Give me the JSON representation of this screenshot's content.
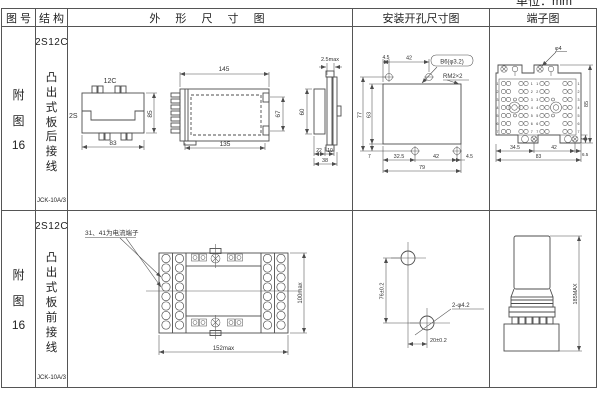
{
  "page": {
    "unit_label": "单位：mm"
  },
  "header": {
    "fig_no": "图 号",
    "structure": "结 构",
    "outline": "外 形 尺 寸 图",
    "mounting": "安装开孔尺寸图",
    "terminal": "端子图"
  },
  "rows": [
    {
      "fig": {
        "l1": "附",
        "l2": "图",
        "l3": "16"
      },
      "structure": {
        "model": "2S12C",
        "desc": "凸出式板后接线",
        "type": "JCK-10A/3"
      },
      "outline": {
        "top_view": {
          "label_top": "12C",
          "label_left": "2S",
          "height": "85",
          "width": "83"
        },
        "side_view": {
          "width_top": "145",
          "width_bottom": "135",
          "height": "67"
        },
        "profile": {
          "thickness": "2.5max",
          "height": "60",
          "d1": "22",
          "d2": "10",
          "d3": "38"
        }
      },
      "mounting": {
        "top_d1": "4.5",
        "top_d2": "42",
        "hole_label": "B6(φ3.2)",
        "thread_label": "RM2×2",
        "left_d1": "77",
        "left_d2": "63",
        "bottom_left": "7",
        "bottom_d1": "32.5",
        "bottom_d2": "42",
        "bottom_d3": "4.5",
        "bottom_total": "79"
      },
      "terminal": {
        "screw_label": "φ4",
        "height": "85",
        "foot_d": "4",
        "bottom_d1": "34.5",
        "bottom_d2": "42",
        "bottom_d3": "6.5",
        "bottom_total": "83",
        "left_rows": [
          "1",
          "2",
          "3",
          "4",
          "5",
          "6",
          "7"
        ],
        "center_rows": [
          "1",
          "2",
          "3",
          "4",
          "5",
          "6",
          "7"
        ],
        "right_rows": [
          "1",
          "2",
          "3",
          "4",
          "5",
          "6",
          "7"
        ]
      }
    },
    {
      "fig": {
        "l1": "附",
        "l2": "图",
        "l3": "16"
      },
      "structure": {
        "model": "2S12C",
        "desc": "凸出式板前接线",
        "type": "JCK-10A/3"
      },
      "outline": {
        "note": "31、41为电流端子",
        "width": "152max",
        "height": "100max"
      },
      "mounting": {
        "v_dim": "76±0.2",
        "h_dim": "20±0.2",
        "hole_label": "2-φ4.2"
      },
      "terminal": {
        "height": "185MAX"
      }
    }
  ]
}
